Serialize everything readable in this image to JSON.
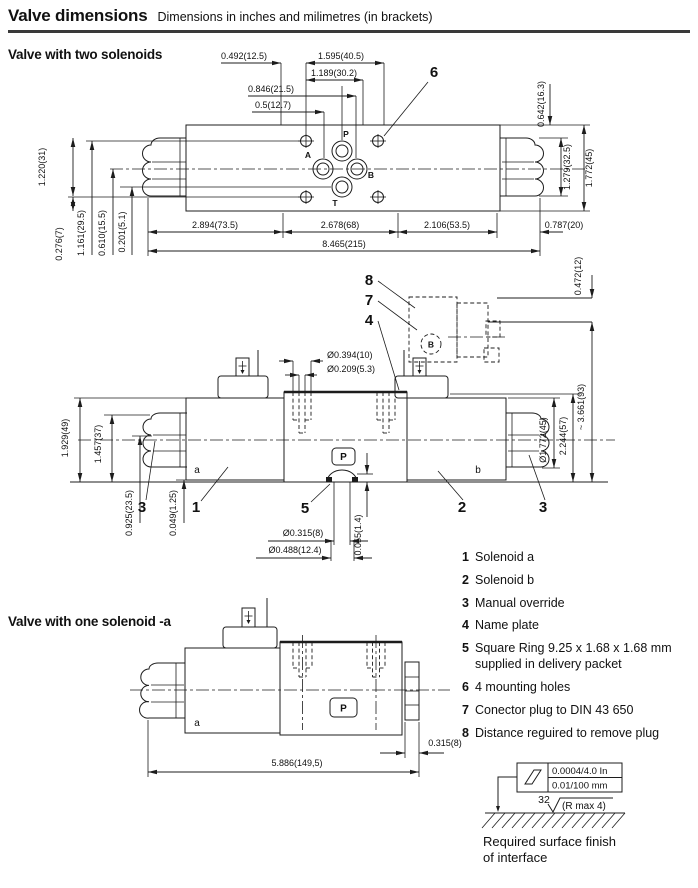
{
  "header": {
    "title": "Valve dimensions",
    "subtitle": "Dimensions in inches and milimetres (in brackets)"
  },
  "section_two": "Valve with two solenoids",
  "section_one": "Valve with one solenoid -a",
  "top_view": {
    "dim_0492": "0.492(12.5)",
    "dim_1595": "1.595(40.5)",
    "dim_1189": "1.189(30.2)",
    "dim_0846": "0.846(21.5)",
    "dim_05": "0.5(12.7)",
    "dim_0642": "0.642(16.3)",
    "dim_1279": "1.279(32.5)",
    "dim_1772": "1.772(45)",
    "dim_1220": "1.220(31)",
    "dim_0276": "0.276(7)",
    "dim_1161": "1.161(29.5)",
    "dim_0610": "0.610(15.5)",
    "dim_0201": "0.201(5.1)",
    "dim_2894": "2.894(73.5)",
    "dim_2678": "2.678(68)",
    "dim_2106": "2.106(53.5)",
    "dim_0787": "0.787(20)",
    "dim_8465": "8.465(215)",
    "port_p": "P",
    "port_a": "A",
    "port_b": "B",
    "port_t": "T",
    "callout_6": "6"
  },
  "side_view": {
    "dim_0472": "0.472(12)",
    "dim_3661": "~ 3.661(93)",
    "dim_2244": "2.244(57)",
    "dim_dia1772": "Ø1.772(45)",
    "dim_dia0394": "Ø0.394(10)",
    "dim_dia0209": "Ø0.209(5.3)",
    "dim_1929": "1.929(49)",
    "dim_1457": "1.457(37)",
    "dim_0925": "0.925(23.5)",
    "dim_0049": "0.049(1.25)",
    "dim_0055": "0.055(1.4)",
    "dim_dia0315": "Ø0.315(8)",
    "dim_dia0488": "Ø0.488(12.4)",
    "label_a": "a",
    "label_b": "b",
    "label_p": "P",
    "label_b_plug": "B",
    "callout_1": "1",
    "callout_2": "2",
    "callout_3_left": "3",
    "callout_3_right": "3",
    "callout_4": "4",
    "callout_5": "5",
    "callout_7": "7",
    "callout_8": "8"
  },
  "one_solenoid_view": {
    "dim_5886": "5.886(149,5)",
    "dim_0315": "0.315(8)",
    "label_a": "a",
    "label_p": "P"
  },
  "legend": {
    "items": [
      {
        "num": "1",
        "text": "Solenoid a"
      },
      {
        "num": "2",
        "text": "Solenoid b"
      },
      {
        "num": "3",
        "text": "Manual override"
      },
      {
        "num": "4",
        "text": "Name plate"
      },
      {
        "num": "5",
        "text": "Square Ring 9.25 x 1.68 x 1.68 mm supplied in delivery packet"
      },
      {
        "num": "6",
        "text": "4 mounting holes"
      },
      {
        "num": "7",
        "text": "Conector plug to DIN 43 650"
      },
      {
        "num": "8",
        "text": "Distance reguired to remove plug"
      }
    ]
  },
  "surface_finish": {
    "spec_inch": "0.0004/4.0 In",
    "spec_mm": "0.01/100 mm",
    "roughness": "32",
    "r_max": "(R max 4)",
    "caption_1": "Required surface finish",
    "caption_2": "of interface"
  }
}
